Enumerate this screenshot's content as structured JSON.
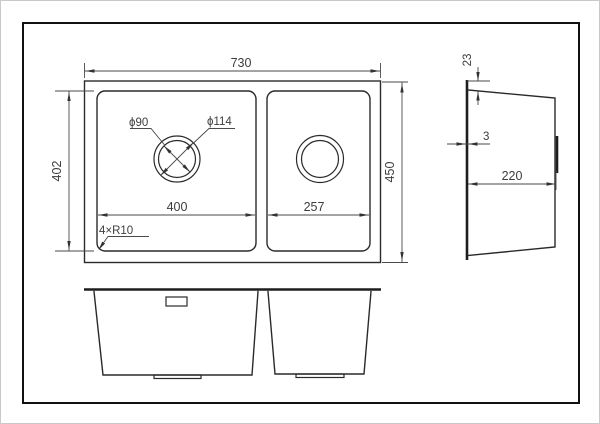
{
  "colors": {
    "background": "#ffffff",
    "frame": "#111111",
    "object_line": "#2a2a2a",
    "dimension_line": "#4a4a4a",
    "text": "#3d3d3d"
  },
  "top_view": {
    "overall_width": "730",
    "inner_depth": "402",
    "overall_depth": "450",
    "left_bowl_width": "400",
    "right_bowl_width": "257",
    "drain_hole_diameter": "ϕ90",
    "drain_flange_diameter": "ϕ114",
    "corner_radius_note": "4×R10"
  },
  "side_view": {
    "rim_height": "23",
    "wall_thickness": "3",
    "bowl_depth": "220"
  }
}
